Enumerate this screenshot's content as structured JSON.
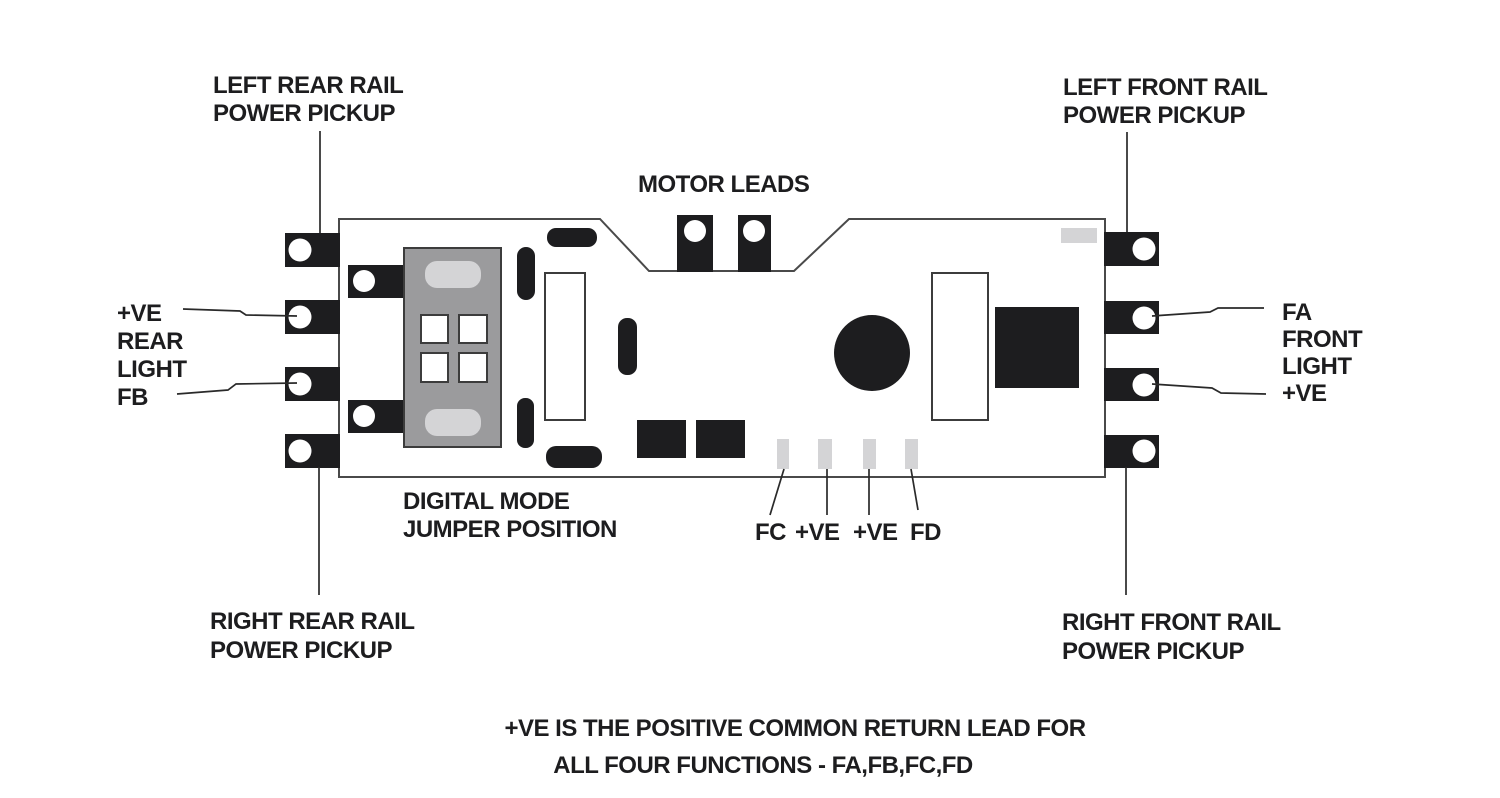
{
  "diagram": {
    "labels": {
      "left_rear_rail": {
        "line1": "LEFT REAR RAIL",
        "line2": "POWER PICKUP"
      },
      "right_rear_rail": {
        "line1": "RIGHT REAR RAIL",
        "line2": "POWER PICKUP"
      },
      "left_front_rail": {
        "line1": "LEFT FRONT RAIL",
        "line2": "POWER PICKUP"
      },
      "right_front_rail": {
        "line1": "RIGHT FRONT RAIL",
        "line2": "POWER PICKUP"
      },
      "motor_leads": "MOTOR LEADS",
      "rear_light": {
        "line1": "+VE",
        "line2": "REAR",
        "line3": "LIGHT",
        "line4": "FB"
      },
      "front_light": {
        "line1": "FA",
        "line2": "FRONT",
        "line3": "LIGHT",
        "line4": "+VE"
      },
      "digital_mode_jumper": {
        "line1": "DIGITAL MODE",
        "line2": "JUMPER POSITION"
      },
      "function_leads": {
        "fc": "FC",
        "plus_ve_1": "+VE",
        "plus_ve_2": "+VE",
        "fd": "FD"
      },
      "footnote": {
        "line1": "+VE IS THE POSITIVE COMMON RETURN LEAD FOR",
        "line2": "ALL FOUR FUNCTIONS - FA,FB,FC,FD"
      }
    },
    "colors": {
      "ink": "#1d1d1f",
      "outline": "#4a4a4a",
      "jumper_gray": "#9b9b9d",
      "pad_gray": "#d4d4d6",
      "background": "#ffffff"
    }
  }
}
